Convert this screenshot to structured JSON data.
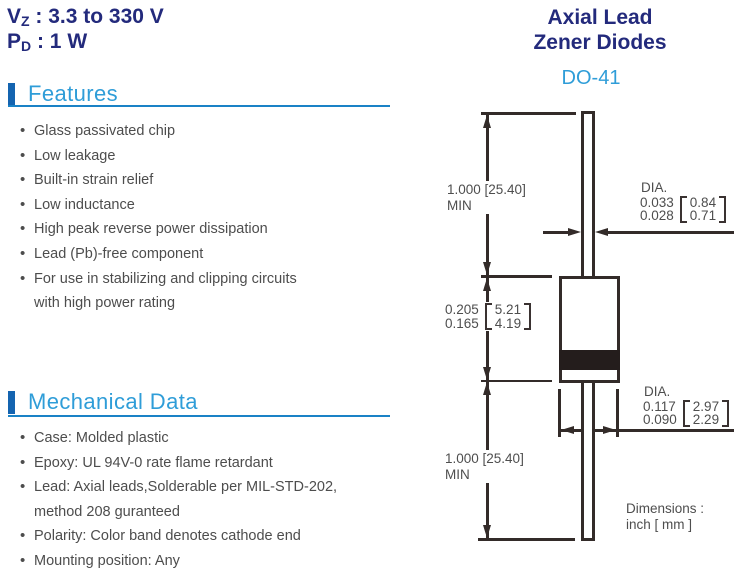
{
  "specs": {
    "vz_symbol": "V",
    "vz_sub": "Z",
    "vz_value": " : 3.3 to 330 V",
    "pd_symbol": "P",
    "pd_sub": "D",
    "pd_value": " : 1 W"
  },
  "title": {
    "line1": "Axial Lead",
    "line2": "Zener Diodes"
  },
  "package": "DO-41",
  "features": {
    "heading": "Features",
    "items": [
      "Glass passivated chip",
      "Low leakage",
      "Built-in strain relief",
      "Low inductance",
      "High peak reverse power dissipation",
      "Lead (Pb)-free component",
      "For use in stabilizing and clipping circuits"
    ],
    "continuation": "with high power rating"
  },
  "mechanical": {
    "heading": "Mechanical Data",
    "items": [
      "Case: Molded plastic",
      "Epoxy: UL 94V-0 rate flame retardant",
      "Lead: Axial leads,Solderable per MIL-STD-202,",
      "Polarity: Color band denotes cathode end",
      "Mounting position: Any"
    ],
    "continuation": "method 208 guranteed"
  },
  "diagram": {
    "lead_length_top": {
      "line1": "1.000 [25.40]",
      "line2": "MIN"
    },
    "lead_length_bottom": {
      "line1": "1.000 [25.40]",
      "line2": "MIN"
    },
    "body_length": {
      "inch_max": "0.205",
      "inch_min": "0.165",
      "mm_max": "5.21",
      "mm_min": "4.19"
    },
    "lead_dia": {
      "label": "DIA.",
      "inch_max": "0.033",
      "inch_min": "0.028",
      "mm_max": "0.84",
      "mm_min": "0.71"
    },
    "body_dia": {
      "label": "DIA.",
      "inch_max": "0.117",
      "inch_min": "0.090",
      "mm_max": "2.97",
      "mm_min": "2.29"
    },
    "note_line1": "Dimensions :",
    "note_line2": "inch [ mm ]"
  },
  "colors": {
    "navy": "#232a7c",
    "light_blue": "#2f9dd8",
    "rule_blue": "#1a82c6",
    "bar_blue": "#1464b0",
    "body_text": "#4d4d4d",
    "drawing_line": "#332b29"
  }
}
